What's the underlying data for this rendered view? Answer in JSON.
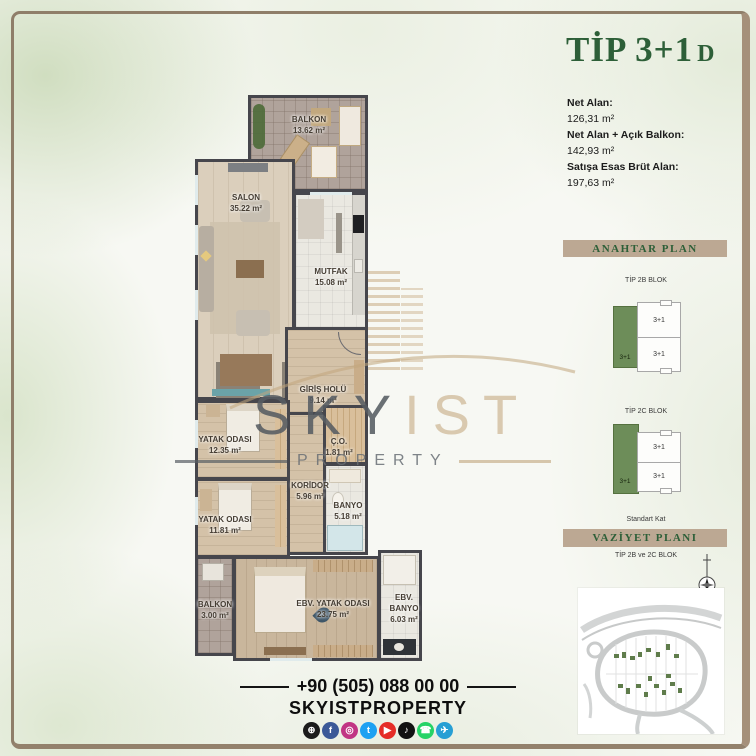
{
  "colors": {
    "accent_green": "#2d5f38",
    "bar_beige": "#bca893",
    "highlight_green": "#6d8d59",
    "wall_gray": "#46464c",
    "frame_brown": "#8f7e69",
    "logo_beige": "#c5ab84"
  },
  "header": {
    "title_main": "TİP 3+1",
    "title_suffix": "D"
  },
  "area_info": {
    "items": [
      {
        "label": "Net Alan:",
        "value": "126,31 m²"
      },
      {
        "label": "Net Alan + Açık Balkon:",
        "value": "142,93 m²"
      },
      {
        "label": "Satışa Esas Brüt Alan:",
        "value": "197,63 m²"
      }
    ]
  },
  "anahtar_plan": {
    "title": "ANAHTAR PLAN",
    "blocks": [
      {
        "name": "TİP 2B BLOK",
        "green_label": "3+1",
        "unit_top": "3+1",
        "unit_bottom": "3+1"
      },
      {
        "name": "TİP 2C BLOK",
        "green_label": "3+1",
        "unit_top": "3+1",
        "unit_bottom": "3+1"
      }
    ],
    "footnote": "Standart Kat"
  },
  "vaziyet_plani": {
    "title": "VAZİYET PLANI",
    "subtitle": "TİP 2B ve 2C BLOK"
  },
  "floor_plan": {
    "rooms": [
      {
        "name": "BALKON",
        "area": "13.62 m²"
      },
      {
        "name": "SALON",
        "area": "35.22 m²"
      },
      {
        "name": "MUTFAK",
        "area": "15.08 m²"
      },
      {
        "name": "GİRİŞ HOLÜ",
        "area": "9.14 m²"
      },
      {
        "name": "YATAK ODASI",
        "area": "12.35 m²"
      },
      {
        "name": "Ç.O.",
        "area": "1.81 m²"
      },
      {
        "name": "KORİDOR",
        "area": "5.96 m²"
      },
      {
        "name": "BANYO",
        "area": "5.18 m²"
      },
      {
        "name": "YATAK ODASI",
        "area": "11.81 m²"
      },
      {
        "name": "BALKON",
        "area": "3.00 m²"
      },
      {
        "name": "EBV. YATAK ODASI",
        "area": "23.75 m²"
      },
      {
        "name": "EBV. BANYO",
        "area": "6.03 m²"
      }
    ]
  },
  "watermark": {
    "brand_main": "SKY",
    "brand_accent": "IST",
    "brand_sub": "PROPERTY"
  },
  "footer": {
    "phone": "+90 (505) 088 00 00",
    "handle": "SKYISTPROPERTY",
    "social": [
      {
        "name": "website",
        "glyph": "⊕",
        "color": "#1b1b1b"
      },
      {
        "name": "facebook",
        "glyph": "f",
        "color": "#3b5998"
      },
      {
        "name": "instagram",
        "glyph": "◎",
        "color": "#c13584"
      },
      {
        "name": "twitter",
        "glyph": "t",
        "color": "#1da1f2"
      },
      {
        "name": "youtube",
        "glyph": "▶",
        "color": "#e52d27"
      },
      {
        "name": "tiktok",
        "glyph": "♪",
        "color": "#121212"
      },
      {
        "name": "whatsapp",
        "glyph": "☎",
        "color": "#25d366"
      },
      {
        "name": "telegram",
        "glyph": "✈",
        "color": "#279fd4"
      }
    ]
  }
}
